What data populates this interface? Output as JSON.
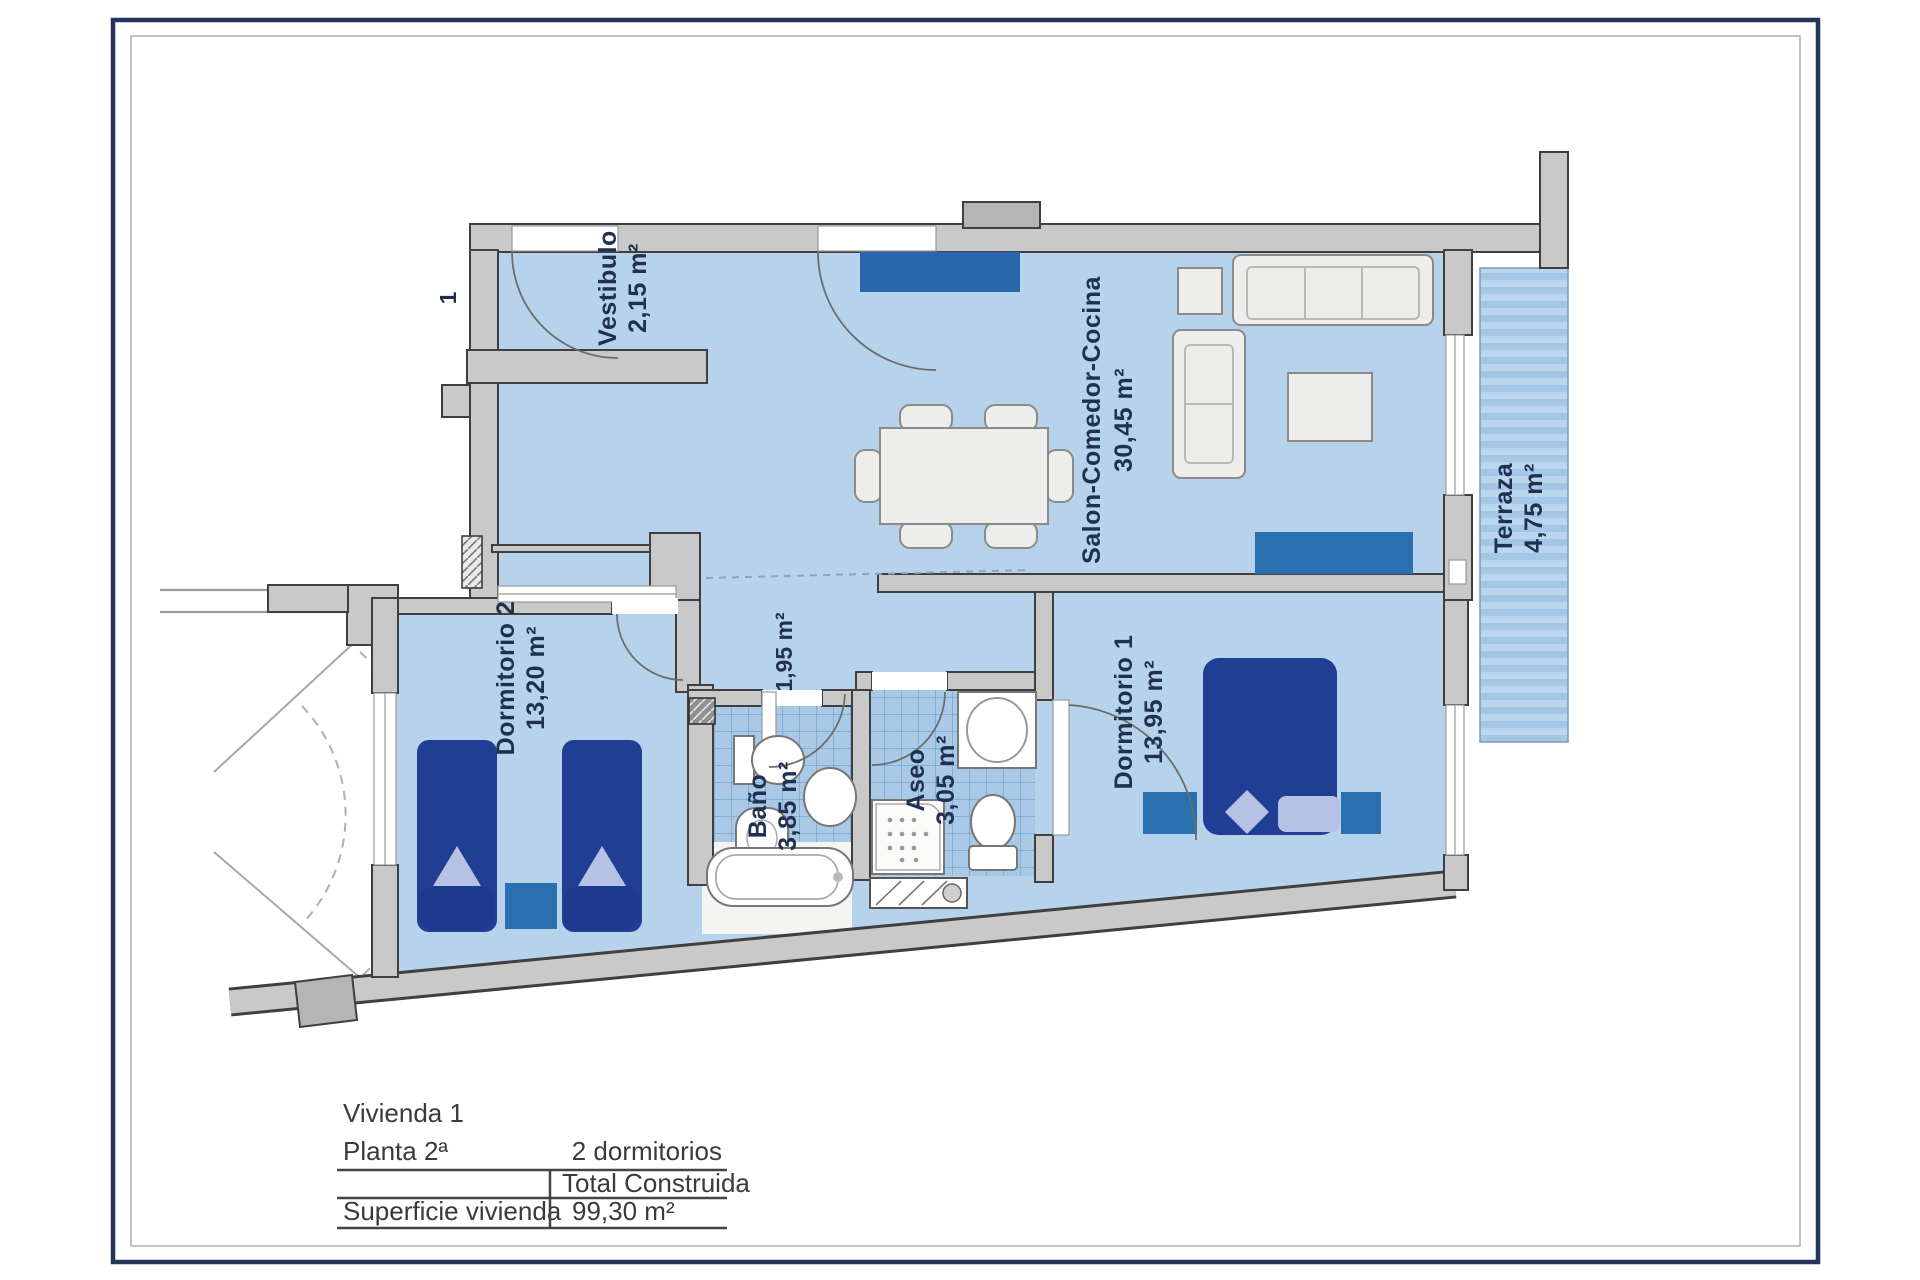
{
  "sheet": {
    "number": "1"
  },
  "rooms": {
    "vestibulo": {
      "name": "Vestibulo",
      "area": "2,15 m²"
    },
    "salon": {
      "name": "Salon-Comedor-Cocina",
      "area": "30,45 m²"
    },
    "terraza": {
      "name": "Terraza",
      "area": "4,75 m²"
    },
    "dormitorio2": {
      "name": "Dormitorio 2",
      "area": "13,20 m²"
    },
    "pasillo": {
      "area": "1,95 m²"
    },
    "bano": {
      "name": "Baño",
      "area": "3,85 m²"
    },
    "aseo": {
      "name": "Aseo",
      "area": "3,05 m²"
    },
    "dormitorio1": {
      "name": "Dormitorio 1",
      "area": "13,95 m²"
    }
  },
  "summary": {
    "unit": "Vivienda 1",
    "floor": "Planta 2ª",
    "bedrooms": "2 dormitorios",
    "total_label": "Total Construida",
    "surface_label": "Superficie vivienda",
    "surface_value": "99,30 m²"
  },
  "colors": {
    "frame_navy": "#26335a",
    "wall_gray": "#c9c9c9",
    "room_blue": "#b7d3ec",
    "tile_blue": "#a9c9e7",
    "furniture_navy": "#203e93",
    "furniture_teal": "#2a6fb0",
    "label_navy": "#1f3050"
  }
}
